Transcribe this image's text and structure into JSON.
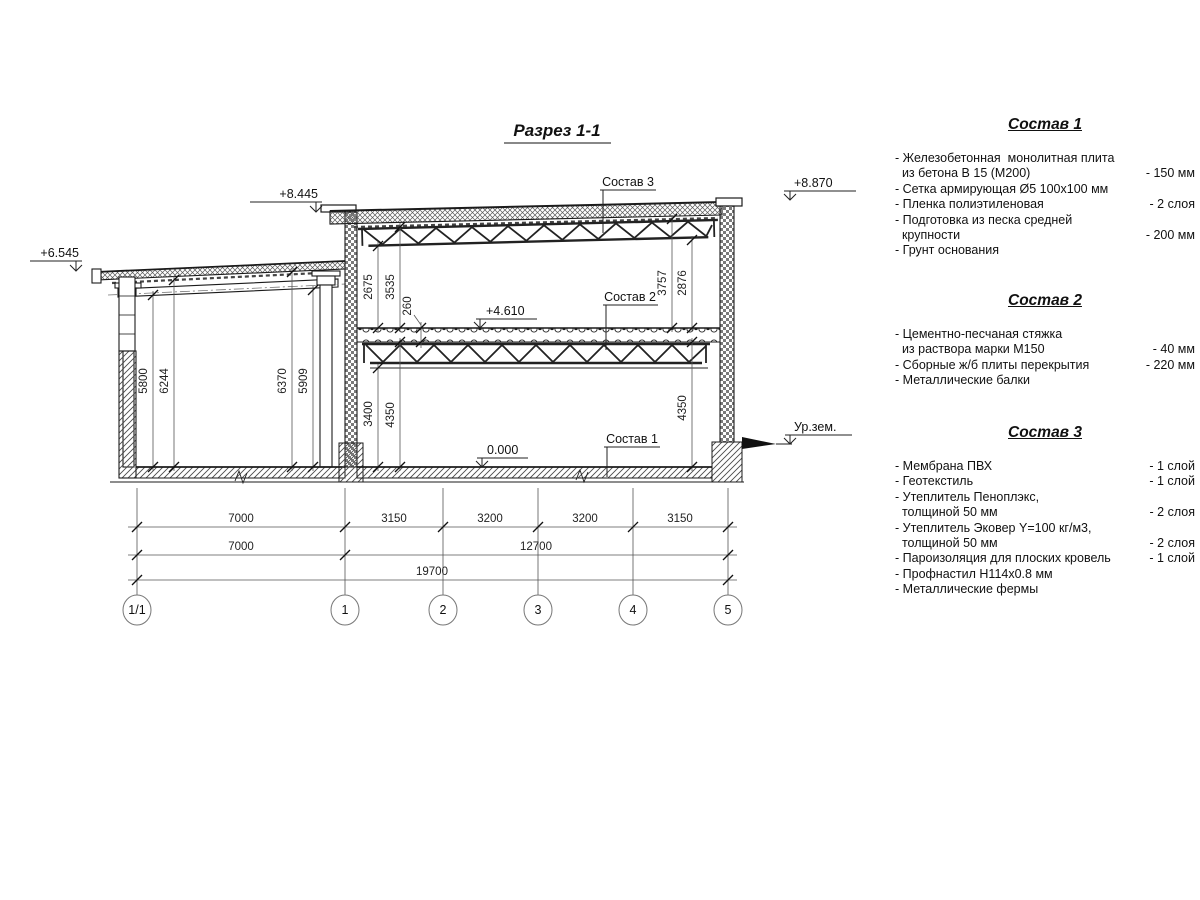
{
  "title": "Разрез 1-1",
  "marks": {
    "left_roof": "+6.545",
    "main_left": "+8.445",
    "main_right": "+8.870",
    "floor2": "+4.610",
    "zero": "0.000",
    "ground": "Ур.зем."
  },
  "layer_refs": {
    "s1": "Состав 1",
    "s2": "Состав 2",
    "s3": "Состав 3"
  },
  "vdims": {
    "annex_1": "5800",
    "annex_2": "6244",
    "annex_3": "6370",
    "annex_4": "5909",
    "hall_top_l1": "2675",
    "hall_top_l2": "3535",
    "slab_thk": "260",
    "hall_top_r1": "3757",
    "hall_top_r2": "2876",
    "hall_bot_l1": "3400",
    "hall_bot_l2": "4350",
    "hall_bot_r1": "4350"
  },
  "hdims": {
    "row1": [
      "7000",
      "3150",
      "3200",
      "3200",
      "3150"
    ],
    "row2": [
      "7000",
      "12700"
    ],
    "row3": [
      "19700"
    ]
  },
  "axes": [
    "1/1",
    "1",
    "2",
    "3",
    "4",
    "5"
  ],
  "specs": [
    {
      "title": "Состав 1",
      "rows": [
        {
          "t": "- Железобетонная  монолитная плита",
          "v": ""
        },
        {
          "t": "  из бетона В 15 (М200)",
          "v": "- 150 мм"
        },
        {
          "t": "- Сетка армирующая Ø5 100х100 мм",
          "v": ""
        },
        {
          "t": "- Пленка полиэтиленовая",
          "v": "- 2 слоя"
        },
        {
          "t": "- Подготовка из песка средней",
          "v": ""
        },
        {
          "t": "  крупности",
          "v": "- 200 мм"
        },
        {
          "t": "- Грунт основания",
          "v": ""
        }
      ]
    },
    {
      "title": "Состав 2",
      "rows": [
        {
          "t": "- Цементно-песчаная стяжка",
          "v": ""
        },
        {
          "t": "  из раствора марки М150",
          "v": "- 40 мм"
        },
        {
          "t": "- Сборные ж/б плиты перекрытия",
          "v": "- 220 мм"
        },
        {
          "t": "- Металлические балки",
          "v": ""
        }
      ]
    },
    {
      "title": "Состав 3",
      "rows": [
        {
          "t": "- Мембрана ПВХ",
          "v": "- 1 слой"
        },
        {
          "t": "- Геотекстиль",
          "v": "- 1 слой"
        },
        {
          "t": "- Утеплитель Пеноплэкс,",
          "v": ""
        },
        {
          "t": "  толщиной 50 мм",
          "v": "- 2 слоя"
        },
        {
          "t": "- Утеплитель Эковер Y=100 кг/м3,",
          "v": ""
        },
        {
          "t": "  толщиной 50 мм",
          "v": "- 2 слоя"
        },
        {
          "t": "- Пароизоляция для плоских кровель",
          "v": "- 1 слой"
        },
        {
          "t": "- Профнастил Н114х0.8 мм",
          "v": ""
        },
        {
          "t": "- Металлические фермы",
          "v": ""
        }
      ]
    }
  ]
}
